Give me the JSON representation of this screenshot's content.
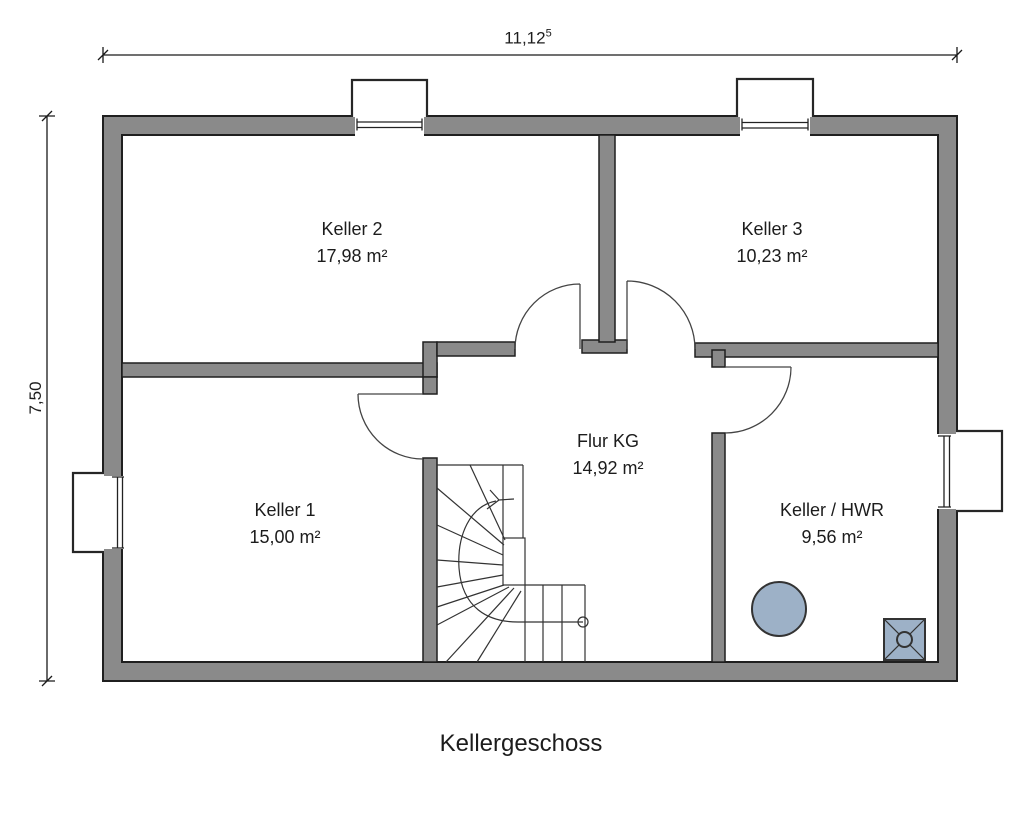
{
  "title": "Kellergeschoss",
  "dimensions": {
    "width_value": "11,12",
    "width_sup": "5",
    "height_value": "7,50"
  },
  "rooms": [
    {
      "name": "Keller 2",
      "area": "17,98 m²"
    },
    {
      "name": "Keller 3",
      "area": "10,23 m²"
    },
    {
      "name": "Keller 1",
      "area": "15,00 m²"
    },
    {
      "name": "Flur KG",
      "area": "14,92 m²"
    },
    {
      "name": "Keller / HWR",
      "area": "9,56 m²"
    }
  ],
  "fixtures": [
    {
      "name": "boiler-circle"
    },
    {
      "name": "floor-drain"
    }
  ],
  "colors": {
    "wall": "#8a8a8a",
    "outline": "#1f1f1f",
    "fixture": "#9db1c7",
    "line": "#333333",
    "text": "#1c1c1c",
    "background": "#ffffff"
  }
}
